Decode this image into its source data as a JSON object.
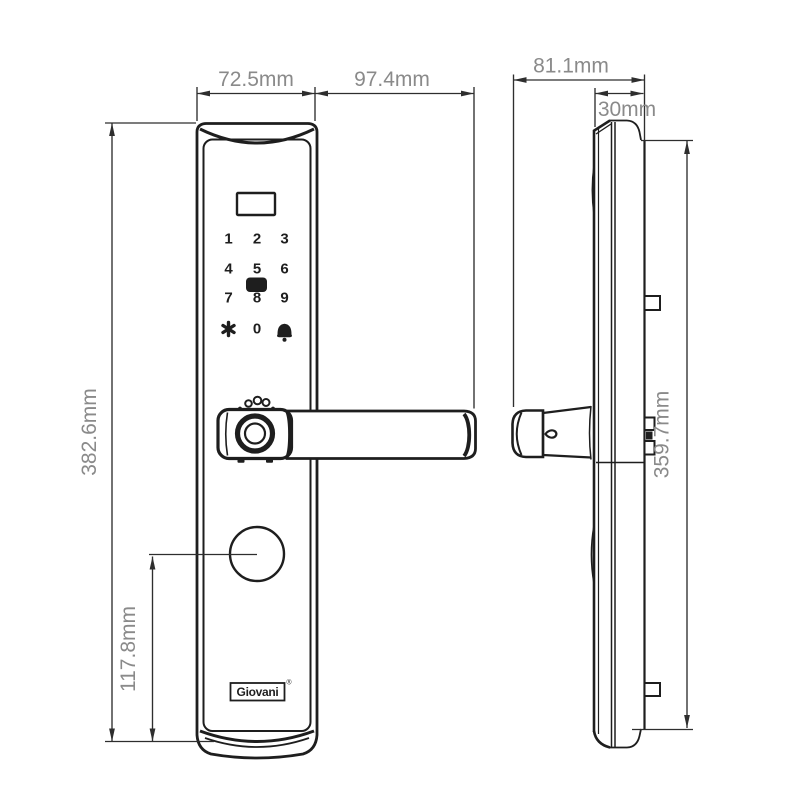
{
  "colors": {
    "background": "#ffffff",
    "line": "#1e1e1e",
    "dim_line": "#2e2e2e",
    "dim_text": "#8a8a8a"
  },
  "dimensions": {
    "front_width": "72.5mm",
    "handle_length": "97.4mm",
    "side_total_depth": "81.1mm",
    "mortise_depth": "30mm",
    "front_height": "382.6mm",
    "keyhole_center_height": "117.8mm",
    "rear_plate_height": "359.7mm"
  },
  "front_view": {
    "keypad": {
      "keys": [
        "1",
        "2",
        "3",
        "4",
        "5",
        "6",
        "7",
        "8",
        "9",
        "0"
      ]
    },
    "brand": {
      "name": "Giovani",
      "registered_mark": "®"
    }
  },
  "icons": {
    "star_key": "6-point heavy asterisk",
    "doorbell_key": "filled bell with clapper",
    "fingerprint_scanner": "concentric rings on handle",
    "display_window": "rectangular screen outline",
    "keyhole_cover": "circle with leader line"
  }
}
